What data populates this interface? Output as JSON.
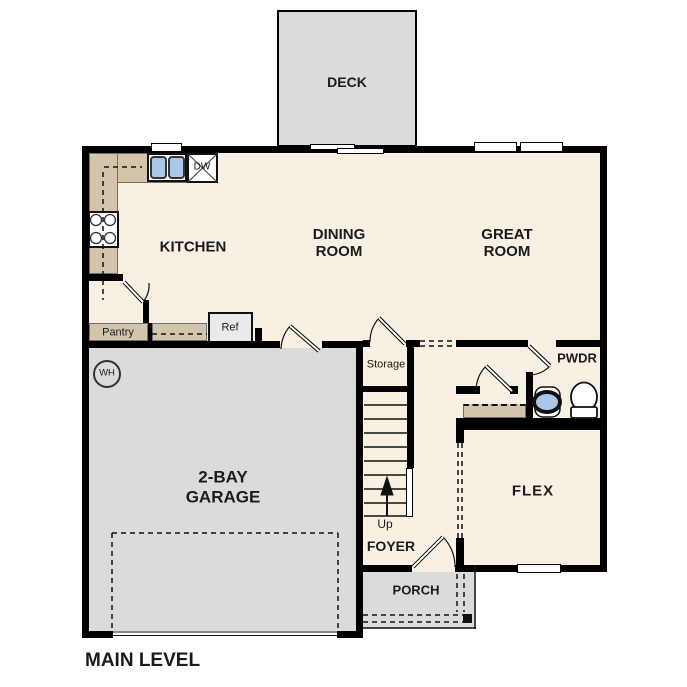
{
  "title": "MAIN LEVEL",
  "labels": {
    "deck": "DECK",
    "kitchen": "KITCHEN",
    "dining_line1": "DINING",
    "dining_line2": "ROOM",
    "great_line1": "GREAT",
    "great_line2": "ROOM",
    "pwdr": "PWDR",
    "flex": "FLEX",
    "garage_line1": "2-BAY",
    "garage_line2": "GARAGE",
    "foyer": "FOYER",
    "porch": "PORCH",
    "storage": "Storage",
    "up": "Up",
    "pantry": "Pantry",
    "ref": "Ref",
    "dishwasher": "DW",
    "water_heater": "WH"
  },
  "colors": {
    "floor_cream": "#f8f0e2",
    "outdoor_gray": "#dcdbd9",
    "counter_tan": "#d2c5ab",
    "fixture_blue": "#aac7e8",
    "wall_black": "#000000",
    "background": "#ffffff"
  }
}
